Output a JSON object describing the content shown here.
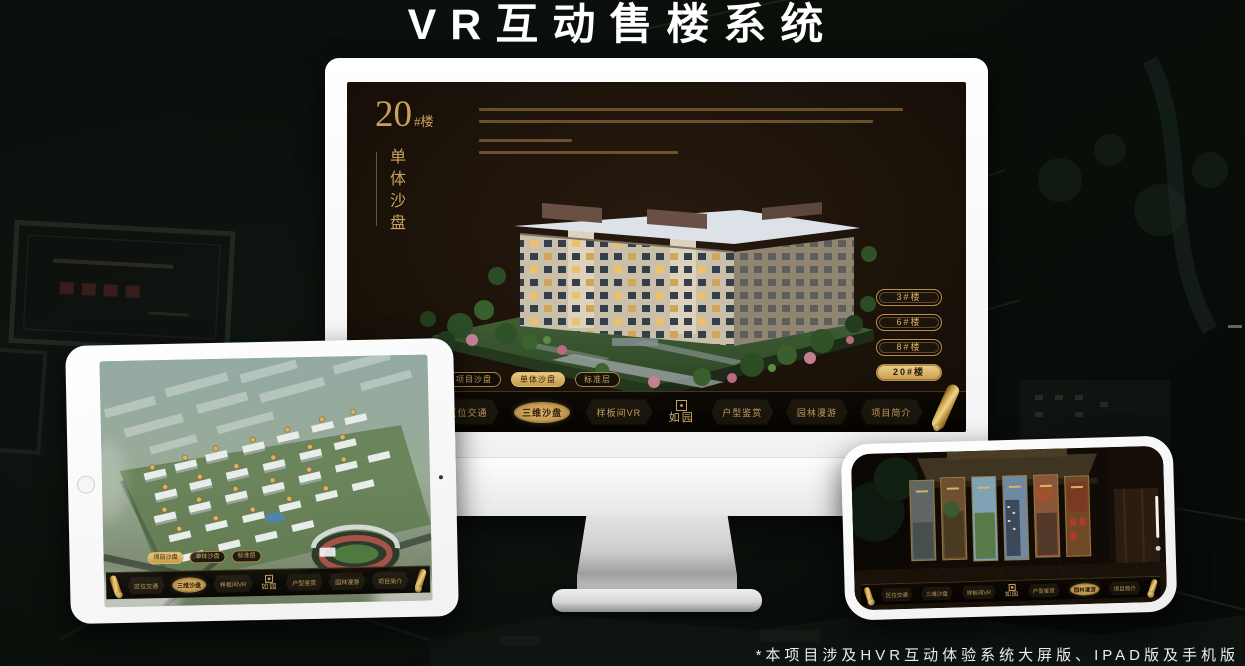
{
  "page": {
    "title": "VR互动售楼系统",
    "footnote": "*本项目涉及HVR互动体验系统大屏版、IPAD版及手机版"
  },
  "colors": {
    "gold": "#c9a25f",
    "gold_bright": "#e9c97f",
    "screen_background": "#1c130a",
    "nav_background": "#0a0703",
    "page_background": "#0a0f0c"
  },
  "monitor": {
    "block": {
      "number": "20",
      "suffix": "#楼",
      "subtitle": "单体沙盘"
    },
    "floor_buttons": [
      {
        "label": "3#楼",
        "active": false
      },
      {
        "label": "6#楼",
        "active": false
      },
      {
        "label": "8#楼",
        "active": false
      },
      {
        "label": "20#楼",
        "active": true
      }
    ],
    "sub_tabs": [
      {
        "label": "项目沙盘",
        "active": false
      },
      {
        "label": "单体沙盘",
        "active": true
      },
      {
        "label": "标准层",
        "active": false
      }
    ],
    "nav": {
      "logo": "如园",
      "items": [
        {
          "label": "区位交通",
          "active": false
        },
        {
          "label": "三维沙盘",
          "active": true
        },
        {
          "label": "样板间VR",
          "active": false
        },
        {
          "label": "户型鉴赏",
          "active": false
        },
        {
          "label": "园林漫游",
          "active": false
        },
        {
          "label": "项目简介",
          "active": false
        }
      ]
    }
  },
  "tablet": {
    "sub_tabs": [
      {
        "label": "项目沙盘",
        "active": true
      },
      {
        "label": "单体沙盘",
        "active": false
      },
      {
        "label": "标准层",
        "active": false
      }
    ],
    "nav": {
      "logo": "如园",
      "items": [
        {
          "label": "区位交通",
          "active": false
        },
        {
          "label": "三维沙盘",
          "active": true
        },
        {
          "label": "样板间VR",
          "active": false
        },
        {
          "label": "户型鉴赏",
          "active": false
        },
        {
          "label": "园林漫游",
          "active": false
        },
        {
          "label": "项目简介",
          "active": false
        }
      ]
    }
  },
  "phone": {
    "nav": {
      "logo": "如园",
      "items": [
        {
          "label": "区位交通",
          "active": false
        },
        {
          "label": "三维沙盘",
          "active": false
        },
        {
          "label": "样板间VR",
          "active": false
        },
        {
          "label": "户型鉴赏",
          "active": false
        },
        {
          "label": "园林漫游",
          "active": true
        },
        {
          "label": "项目简介",
          "active": false
        }
      ]
    }
  }
}
